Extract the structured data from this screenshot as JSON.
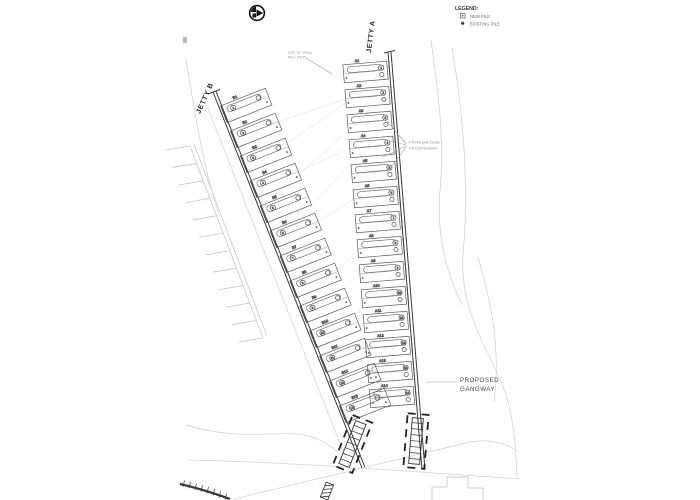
{
  "legend": {
    "title": "LEGEND:",
    "items": [
      {
        "symbol": "square-dot",
        "label": "NEW PILE"
      },
      {
        "symbol": "filled-dot",
        "label": "EXISTING PILE"
      }
    ]
  },
  "labels": {
    "jetty_a": "JETTY A",
    "jetty_b": "JETTY B"
  },
  "annotations": {
    "proposed_gangway": {
      "line1": "PROPOSED",
      "line2": "GANGWAY"
    },
    "pull_note": {
      "line1": "4 Point pull Circle /",
      "line2": "4 ft Connections"
    },
    "top_note": {
      "line1": "LOC OF TRIAL",
      "line2": "PILE (TYP)"
    }
  },
  "berths": {
    "jetty_a_ids": [
      "A1",
      "A2",
      "A3",
      "A4",
      "A5",
      "A6",
      "A7",
      "A8",
      "A9",
      "A10",
      "A11",
      "A12",
      "A13",
      "A14"
    ],
    "jetty_b_ids": [
      "B1",
      "B2",
      "B3",
      "B4",
      "B5",
      "B6",
      "B7",
      "B8",
      "B9",
      "B10",
      "B11",
      "B12",
      "B13"
    ]
  },
  "colors": {
    "ink": "#3a3a3a",
    "medium": "#555555",
    "faint": "#c9c9c9",
    "background": "#ffffff"
  }
}
